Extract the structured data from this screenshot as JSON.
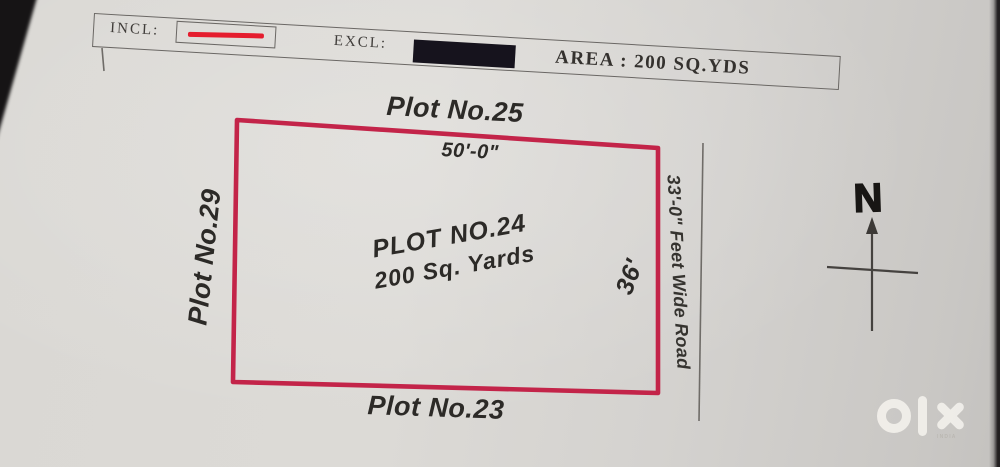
{
  "legend": {
    "incl_label": "INCL:",
    "excl_label": "EXCL:",
    "area_label": "AREA : 200 SQ.YDS",
    "incl_sample_color": "#e51d2e",
    "excl_sample_color": "#16131d"
  },
  "plan": {
    "outline_color": "#c32449",
    "top_neighbor_label": "Plot No.25",
    "top_dimension": "50'-0\"",
    "left_neighbor_label": "Plot No.29",
    "bottom_neighbor_label": "Plot No.23",
    "center_title": "PLOT NO.24",
    "center_area": "200 Sq. Yards",
    "right_dimension": "36'",
    "road_label": "33'-0\" Feet Wide Road"
  },
  "compass": {
    "north_label": "N"
  },
  "watermark": {
    "brand": "olx",
    "sub_label": "INDIA"
  }
}
